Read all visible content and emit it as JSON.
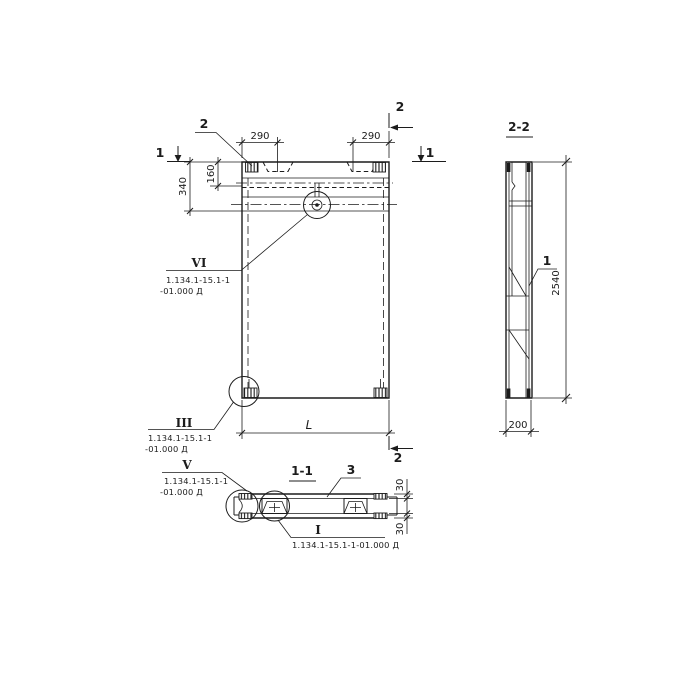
{
  "colors": {
    "ink": "#1c1c1c",
    "paper": "#ffffff"
  },
  "front_view": {
    "embed_callout_label": "2",
    "section_cut_2_top": "2",
    "section_cut_2_bottom": "2",
    "section_cut_1_left": "1",
    "section_cut_1_right": "1",
    "dim_290_left": "290",
    "dim_290_right": "290",
    "dim_160": "160",
    "dim_340": "340",
    "dim_length": "L",
    "detail_vi": {
      "label": "VI",
      "ref_line1": "1.134.1-15.1-1",
      "ref_line2": "-01.000 Д"
    },
    "detail_iii": {
      "label": "III",
      "ref_line1": "1.134.1-15.1-1",
      "ref_line2": "-01.000 Д"
    }
  },
  "section_view": {
    "title": "2-2",
    "dim_height": "2540",
    "dim_thickness": "200",
    "part_label_1": "1"
  },
  "plan_view": {
    "title": "1-1",
    "part_label_3": "3",
    "dim_30_top": "30",
    "dim_30_bottom": "30",
    "detail_v": {
      "label": "V",
      "ref_line1": "1.134.1-15.1-1",
      "ref_line2": "-01.000 Д"
    },
    "detail_i": {
      "label": "I",
      "ref": "1.134.1-15.1-1-01.000 Д"
    }
  }
}
